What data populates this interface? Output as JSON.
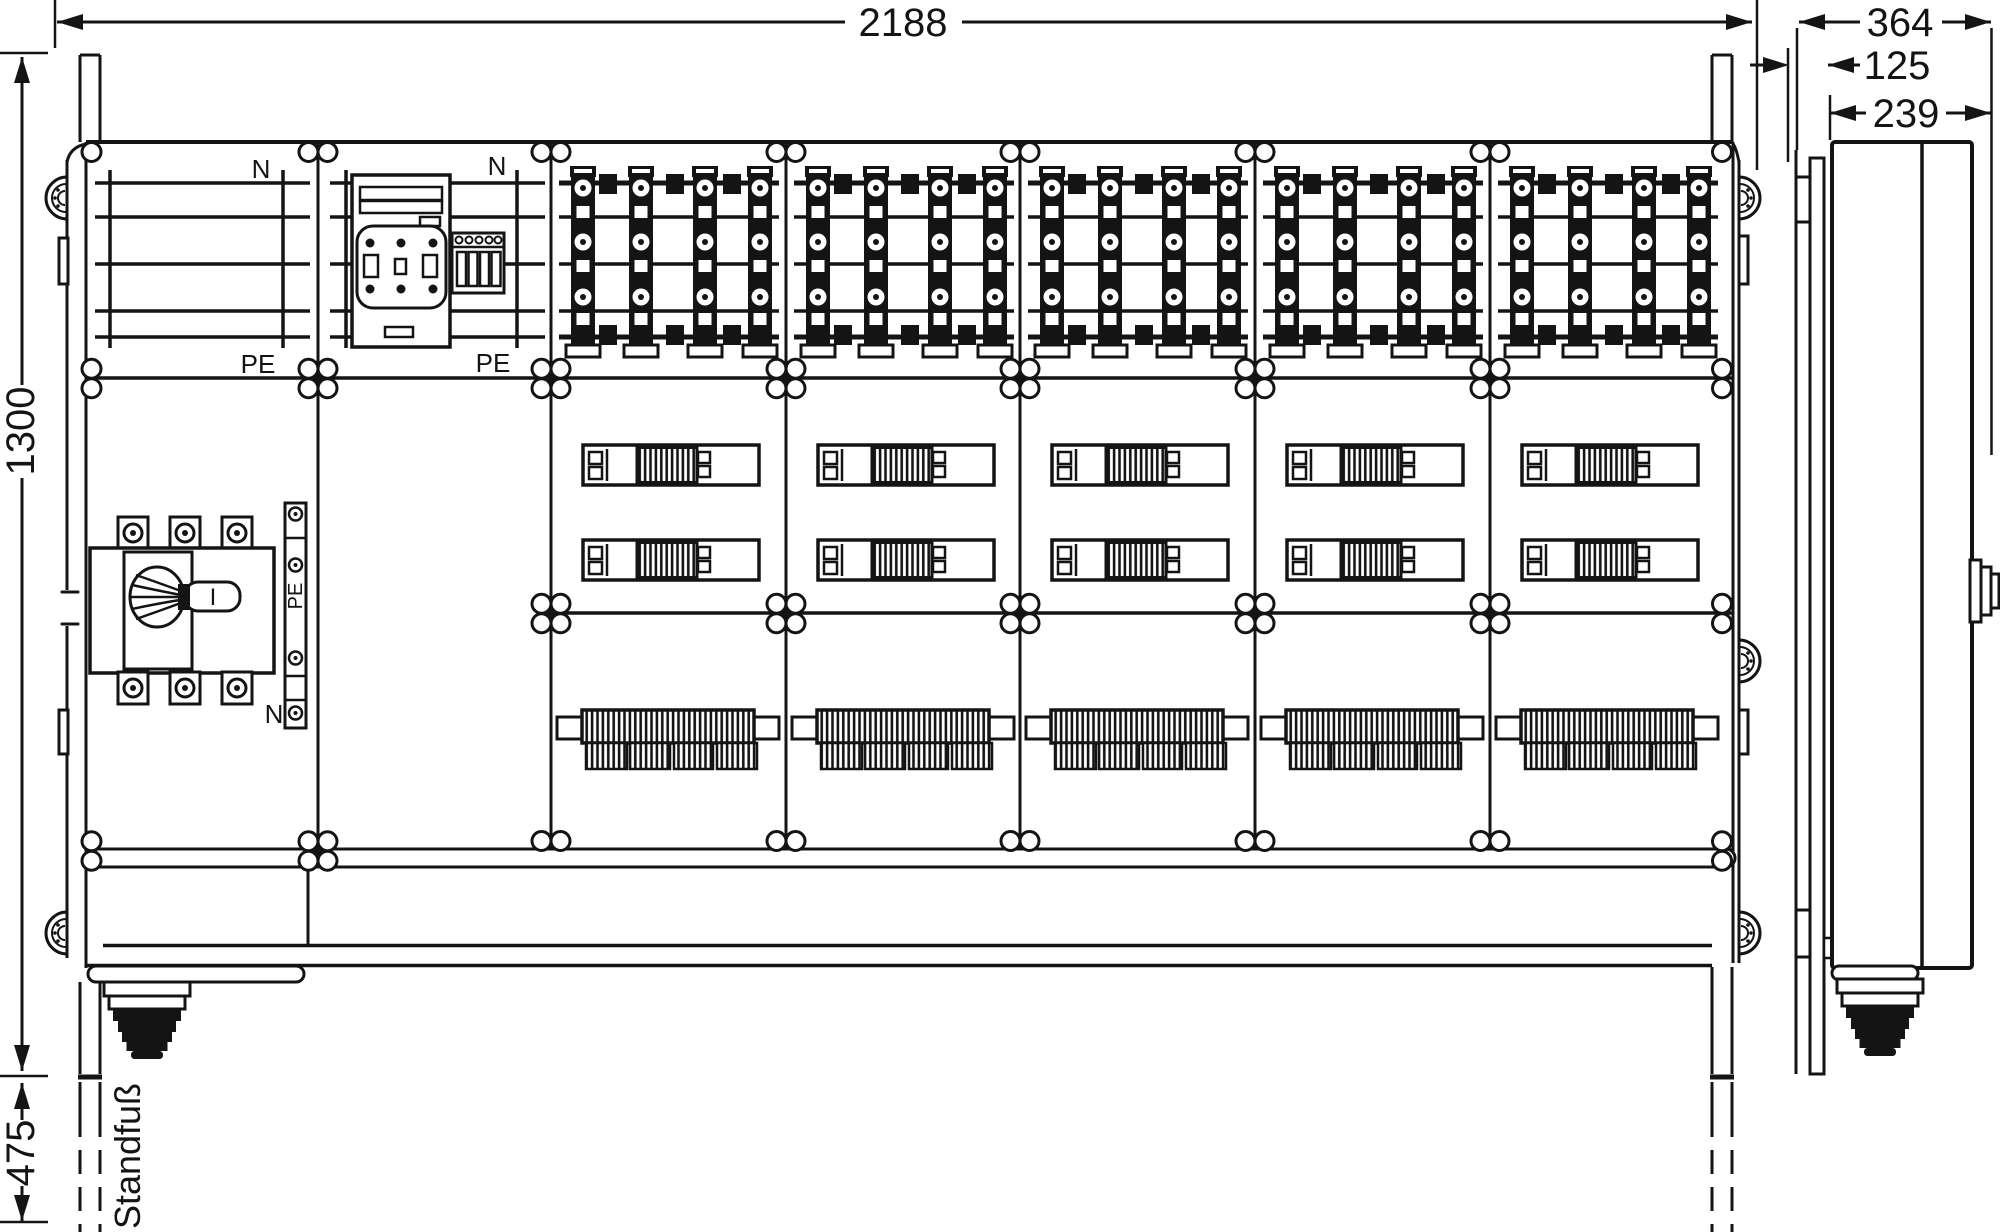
{
  "drawing": {
    "dimensions": {
      "total_width": "2188",
      "cabinet_height": "1300",
      "stand_height": "475",
      "side_total_depth": "364",
      "side_plate_depth": "125",
      "side_body_depth": "239"
    },
    "labels": {
      "stand_foot": "Standfuß",
      "busbar_panel_top": "N",
      "busbar_panel_bottom": "PE",
      "meter_panel_top": "N",
      "meter_panel_bottom": "PE",
      "pe_rail": "PE",
      "neutral_rail": "N",
      "main_switch_position": "I"
    },
    "line_color": "#141414",
    "background_color": "#ffffff"
  }
}
